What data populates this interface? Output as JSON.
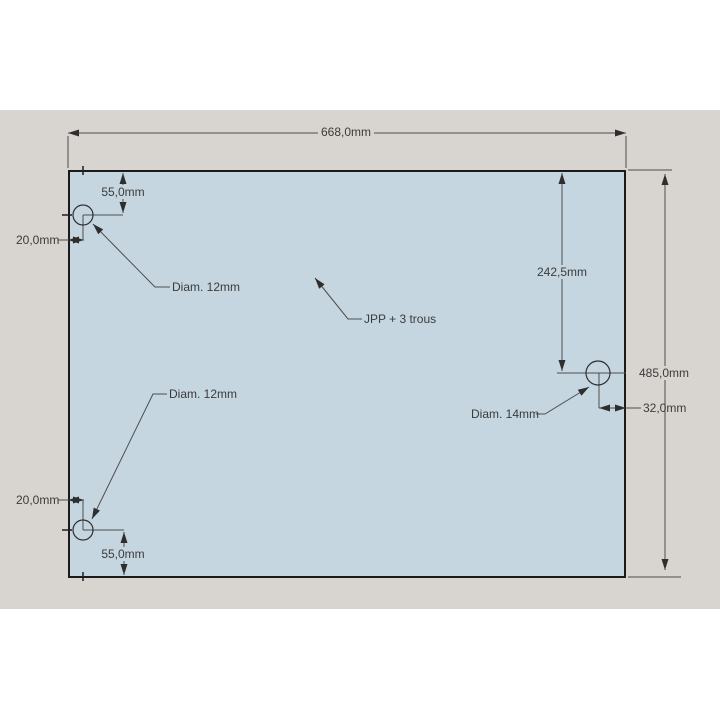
{
  "drawing": {
    "part_note": "JPP + 3 trous",
    "overall": {
      "width_label": "668,0mm",
      "height_label": "485,0mm"
    },
    "top_left_hole": {
      "from_top": "55,0mm",
      "from_left": "20,0mm",
      "diameter": "Diam. 12mm"
    },
    "right_hole": {
      "from_top": "242,5mm",
      "from_right_edge": "32,0mm",
      "diameter": "Diam. 14mm"
    },
    "bottom_left_hole": {
      "from_left": "20,0mm",
      "from_bottom": "55,0mm",
      "diameter": "Diam. 12mm"
    },
    "colors": {
      "page_bg": "#ffffff",
      "canvas_bg": "#d8d5d0",
      "plate_fill": "#c5d6e0",
      "plate_border": "#1a1a1a",
      "dimension_line": "#4d4d4d",
      "text": "#3b3b3b"
    }
  }
}
